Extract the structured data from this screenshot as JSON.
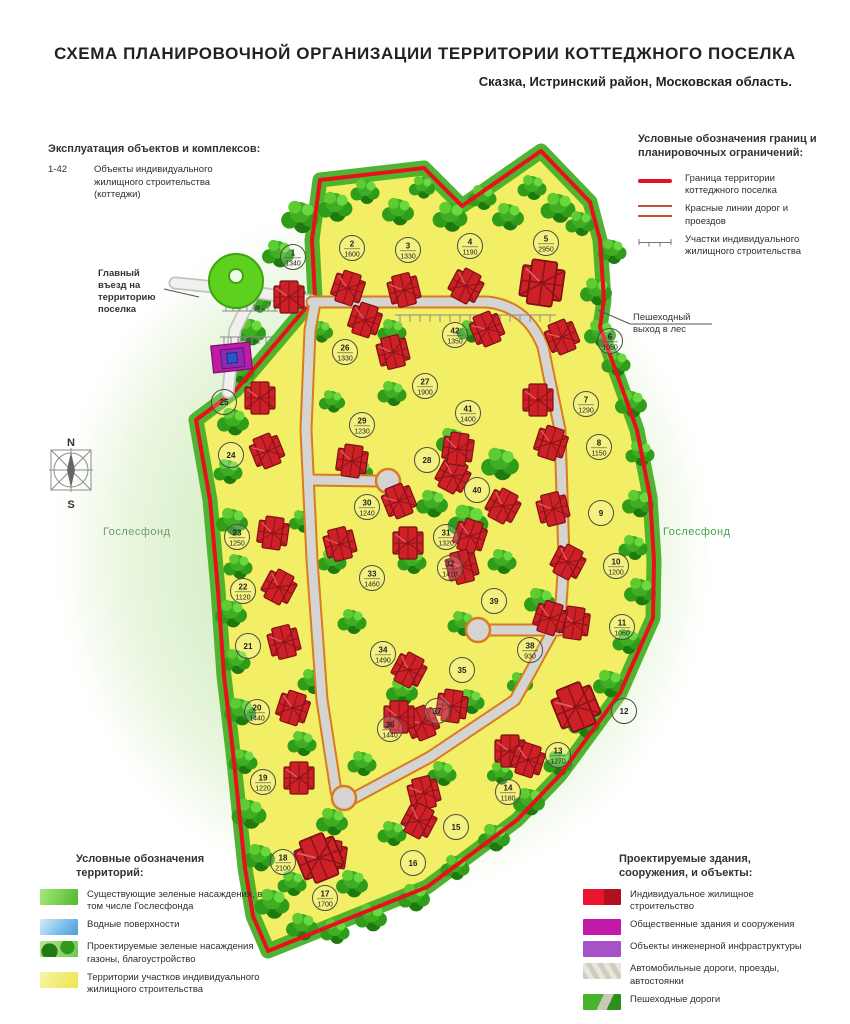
{
  "title": "СХЕМА ПЛАНИРОВОЧНОЙ ОРГАНИЗАЦИИ ТЕРРИТОРИИ КОТТЕДЖНОГО ПОСЕЛКА",
  "subtitle": "Сказка, Истринский район, Московская область.",
  "legend_top_left": {
    "heading": "Эксплуатация объектов и комплексов:",
    "range": "1-42",
    "label": "Объекты индивидуального жилищного строительства (коттеджи)"
  },
  "legend_top_right": {
    "heading": "Условные обозначения границ и планировочных ограничений:",
    "items": [
      {
        "label": "Граница территории коттеджного поселка"
      },
      {
        "label": "Красные линии дорог и проездов"
      },
      {
        "label": "Участки индивидуального жилищного строительства"
      }
    ]
  },
  "legend_territories": {
    "heading": "Условные обозначения территорий:",
    "items": [
      {
        "label": "Существующие зеленые насаждения, в том числе Гослесфонда"
      },
      {
        "label": "Водные поверхности"
      },
      {
        "label": "Проектируемые зеленые насаждения газоны, благоустройство"
      },
      {
        "label": "Территории участков индивидуального жилищного строительства"
      }
    ]
  },
  "legend_objects": {
    "heading": "Проектируемые здания, сооружения, и объекты:",
    "items": [
      {
        "label": "Индивидуальное жилищное строительство"
      },
      {
        "label": "Общественные здания и сооружения"
      },
      {
        "label": "Объекты инженерной инфраструктуры"
      },
      {
        "label": "Автомобильные дороги, проезды, автостоянки"
      },
      {
        "label": "Пешеходные дороги"
      }
    ]
  },
  "map_labels": {
    "main_entrance": "Главный въезд на территорию поселка",
    "pedestrian_exit": "Пешеходный выход в лес",
    "gosles_left": "Гослесфонд",
    "gosles_right": "Гослесфонд",
    "compass_n": "N",
    "compass_s": "S"
  },
  "colors": {
    "boundary": "#e8101c",
    "territory": "#f2ee65",
    "forest": "#2f9c1a",
    "road": "#d4d4d2",
    "road_edge": "#d97b1e",
    "house": "#cd2127",
    "public_building": "#c01aa6",
    "infrastructure": "#a653c6"
  },
  "plots": [
    {
      "n": 1,
      "area": "1340",
      "x": 293,
      "y": 257
    },
    {
      "n": 2,
      "area": "1600",
      "x": 352,
      "y": 248
    },
    {
      "n": 3,
      "area": "1330",
      "x": 408,
      "y": 250
    },
    {
      "n": 4,
      "area": "1190",
      "x": 470,
      "y": 246
    },
    {
      "n": 5,
      "area": "2950",
      "x": 546,
      "y": 243
    },
    {
      "n": 6,
      "area": "1050",
      "x": 610,
      "y": 341
    },
    {
      "n": 7,
      "area": "1290",
      "x": 586,
      "y": 404
    },
    {
      "n": 8,
      "area": "1150",
      "x": 599,
      "y": 447
    },
    {
      "n": 9,
      "area": "",
      "x": 601,
      "y": 513
    },
    {
      "n": 10,
      "area": "1200",
      "x": 616,
      "y": 566
    },
    {
      "n": 11,
      "area": "1060",
      "x": 622,
      "y": 627
    },
    {
      "n": 12,
      "area": "",
      "x": 624,
      "y": 711
    },
    {
      "n": 13,
      "area": "1270",
      "x": 558,
      "y": 755
    },
    {
      "n": 14,
      "area": "1180",
      "x": 508,
      "y": 792
    },
    {
      "n": 15,
      "area": "",
      "x": 456,
      "y": 827
    },
    {
      "n": 16,
      "area": "",
      "x": 413,
      "y": 863
    },
    {
      "n": 17,
      "area": "1700",
      "x": 325,
      "y": 898
    },
    {
      "n": 18,
      "area": "2100",
      "x": 283,
      "y": 862
    },
    {
      "n": 19,
      "area": "1220",
      "x": 263,
      "y": 782
    },
    {
      "n": 20,
      "area": "1440",
      "x": 257,
      "y": 712
    },
    {
      "n": 21,
      "area": "",
      "x": 248,
      "y": 646
    },
    {
      "n": 22,
      "area": "1120",
      "x": 243,
      "y": 591
    },
    {
      "n": 23,
      "area": "1250",
      "x": 237,
      "y": 537
    },
    {
      "n": 24,
      "area": "",
      "x": 231,
      "y": 455
    },
    {
      "n": 25,
      "area": "",
      "x": 224,
      "y": 402
    },
    {
      "n": 26,
      "area": "1330",
      "x": 345,
      "y": 352
    },
    {
      "n": 27,
      "area": "1900",
      "x": 425,
      "y": 386
    },
    {
      "n": 28,
      "area": "",
      "x": 427,
      "y": 460
    },
    {
      "n": 29,
      "area": "1230",
      "x": 362,
      "y": 425
    },
    {
      "n": 30,
      "area": "1240",
      "x": 367,
      "y": 507
    },
    {
      "n": 31,
      "area": "1320",
      "x": 446,
      "y": 537
    },
    {
      "n": 32,
      "area": "1410",
      "x": 450,
      "y": 568
    },
    {
      "n": 33,
      "area": "1460",
      "x": 372,
      "y": 578
    },
    {
      "n": 34,
      "area": "1490",
      "x": 383,
      "y": 654
    },
    {
      "n": 35,
      "area": "",
      "x": 462,
      "y": 670
    },
    {
      "n": 36,
      "area": "1440",
      "x": 390,
      "y": 729
    },
    {
      "n": 37,
      "area": "",
      "x": 437,
      "y": 711
    },
    {
      "n": 38,
      "area": "930",
      "x": 530,
      "y": 650
    },
    {
      "n": 39,
      "area": "",
      "x": 494,
      "y": 601
    },
    {
      "n": 40,
      "area": "",
      "x": 477,
      "y": 490
    },
    {
      "n": 41,
      "area": "1400",
      "x": 468,
      "y": 413
    },
    {
      "n": 42,
      "area": "1350",
      "x": 455,
      "y": 335
    }
  ]
}
